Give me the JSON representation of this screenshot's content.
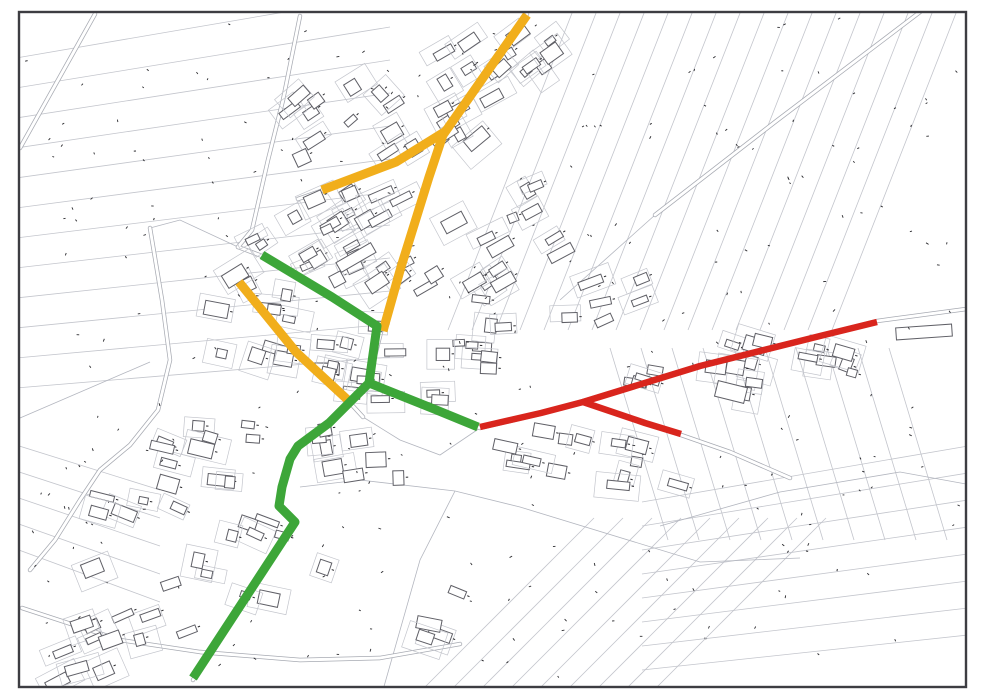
{
  "page": {
    "background": "#ffffff"
  },
  "map": {
    "type": "cadastral-plan-with-route-overlays",
    "frame": {
      "x": 19,
      "y": 12,
      "width": 947,
      "height": 675,
      "stroke": "#3d3d42",
      "stroke_width": 2.4
    },
    "palette": {
      "parcel_line": "#c3c5cc",
      "boundary_line": "#b3b6bf",
      "building_outline": "#5f5f66",
      "building_fill": "#ffffff",
      "road_casing": "#a7aab2",
      "road_fill": "#ffffff",
      "label_speck": "#2a2a2e",
      "route_yellow": "#F1AE1B",
      "route_green": "#3DA639",
      "route_red": "#D9251D"
    },
    "routes": [
      {
        "name": "route-yellow-main-north",
        "color_key": "route_yellow",
        "width": 9,
        "points": [
          [
            527,
            15
          ],
          [
            443,
            135
          ],
          [
            429,
            177
          ],
          [
            401,
            267
          ],
          [
            383,
            331
          ]
        ]
      },
      {
        "name": "route-yellow-branch-west",
        "color_key": "route_yellow",
        "width": 9,
        "points": [
          [
            446,
            131
          ],
          [
            396,
            162
          ],
          [
            322,
            190
          ]
        ]
      },
      {
        "name": "route-yellow-secondary-sw",
        "color_key": "route_yellow",
        "width": 9,
        "points": [
          [
            239,
            282
          ],
          [
            296,
            352
          ],
          [
            350,
            402
          ]
        ]
      },
      {
        "name": "route-green-northeast-diagonal",
        "color_key": "route_green",
        "width": 9,
        "points": [
          [
            262,
            255
          ],
          [
            332,
            297
          ],
          [
            377,
            326
          ],
          [
            369,
            383
          ]
        ]
      },
      {
        "name": "route-green-east-connector",
        "color_key": "route_green",
        "width": 9,
        "points": [
          [
            369,
            383
          ],
          [
            404,
            397
          ],
          [
            434,
            409
          ],
          [
            478,
            427
          ]
        ]
      },
      {
        "name": "route-green-south-main",
        "color_key": "route_green",
        "width": 9,
        "points": [
          [
            369,
            383
          ],
          [
            349,
            403
          ],
          [
            329,
            423
          ],
          [
            298,
            446
          ],
          [
            290,
            459
          ],
          [
            282,
            487
          ],
          [
            279,
            506
          ],
          [
            295,
            522
          ],
          [
            193,
            678
          ]
        ]
      },
      {
        "name": "route-red-east-main",
        "color_key": "route_red",
        "width": 6.5,
        "points": [
          [
            480,
            427
          ],
          [
            541,
            413
          ],
          [
            583,
            402
          ],
          [
            700,
            366
          ],
          [
            820,
            336
          ],
          [
            877,
            322
          ]
        ]
      },
      {
        "name": "route-red-south-branch",
        "color_key": "route_red",
        "width": 6.5,
        "points": [
          [
            583,
            402
          ],
          [
            645,
            423
          ],
          [
            681,
            434
          ]
        ]
      }
    ],
    "roads": [
      {
        "name": "road-main-north",
        "points": [
          [
            527,
            14
          ],
          [
            443,
            135
          ],
          [
            428,
            178
          ],
          [
            400,
            268
          ],
          [
            381,
            332
          ],
          [
            368,
            384
          ]
        ]
      },
      {
        "name": "road-southwest-main",
        "points": [
          [
            368,
            384
          ],
          [
            348,
            404
          ],
          [
            328,
            424
          ],
          [
            297,
            447
          ],
          [
            289,
            460
          ],
          [
            281,
            487
          ],
          [
            278,
            506
          ],
          [
            294,
            522
          ],
          [
            193,
            680
          ]
        ]
      },
      {
        "name": "road-branch-west",
        "points": [
          [
            450,
            128
          ],
          [
            393,
            164
          ],
          [
            318,
            192
          ],
          [
            298,
            199
          ]
        ]
      },
      {
        "name": "road-green-diagonal",
        "points": [
          [
            238,
            247
          ],
          [
            262,
            256
          ],
          [
            330,
            296
          ],
          [
            378,
            326
          ]
        ]
      },
      {
        "name": "road-yellow-secondary",
        "points": [
          [
            236,
            279
          ],
          [
            295,
            351
          ],
          [
            352,
            405
          ],
          [
            363,
            417
          ]
        ]
      },
      {
        "name": "road-east-main",
        "points": [
          [
            368,
            384
          ],
          [
            432,
            410
          ],
          [
            480,
            428
          ],
          [
            540,
            414
          ],
          [
            583,
            401
          ],
          [
            700,
            366
          ],
          [
            877,
            321
          ],
          [
            966,
            309
          ]
        ]
      },
      {
        "name": "road-east-branch",
        "points": [
          [
            583,
            401
          ],
          [
            648,
            424
          ],
          [
            684,
            436
          ],
          [
            730,
            452
          ],
          [
            790,
            478
          ]
        ]
      },
      {
        "name": "road-west-ring",
        "points": [
          [
            150,
            228
          ],
          [
            162,
            300
          ],
          [
            170,
            360
          ],
          [
            158,
            410
          ],
          [
            130,
            445
          ],
          [
            100,
            470
          ],
          [
            80,
            500
          ],
          [
            55,
            540
          ],
          [
            30,
            570
          ]
        ]
      },
      {
        "name": "road-south-lower",
        "points": [
          [
            22,
            608
          ],
          [
            120,
            640
          ],
          [
            200,
            652
          ],
          [
            300,
            660
          ],
          [
            380,
            658
          ],
          [
            460,
            644
          ]
        ]
      },
      {
        "name": "road-northwest-diag",
        "points": [
          [
            20,
            148
          ],
          [
            95,
            14
          ]
        ]
      },
      {
        "name": "road-north-entrance",
        "points": [
          [
            300,
            16
          ],
          [
            283,
            100
          ],
          [
            268,
            160
          ],
          [
            252,
            230
          ],
          [
            238,
            247
          ]
        ]
      },
      {
        "name": "road-northeast-diag",
        "points": [
          [
            655,
            215
          ],
          [
            775,
            122
          ],
          [
            920,
            12
          ]
        ]
      }
    ],
    "boundaries": [
      {
        "points": [
          [
            560,
            300
          ],
          [
            655,
            215
          ]
        ]
      },
      {
        "points": [
          [
            300,
            487
          ],
          [
            360,
            480
          ],
          [
            455,
            491
          ],
          [
            520,
            507
          ],
          [
            700,
            562
          ],
          [
            800,
            558
          ]
        ]
      },
      {
        "points": [
          [
            455,
            491
          ],
          [
            420,
            560
          ],
          [
            383,
            690
          ]
        ]
      },
      {
        "points": [
          [
            660,
            526
          ],
          [
            780,
            492
          ],
          [
            900,
            472
          ],
          [
            966,
            484
          ]
        ]
      },
      {
        "points": [
          [
            20,
            418
          ],
          [
            150,
            362
          ]
        ]
      },
      {
        "points": [
          [
            238,
            247
          ],
          [
            180,
            220
          ],
          [
            150,
            228
          ]
        ]
      },
      {
        "points": [
          [
            363,
            417
          ],
          [
            400,
            440
          ],
          [
            440,
            455
          ],
          [
            480,
            428
          ]
        ]
      }
    ],
    "fields": [
      {
        "name": "field-strips-northwest",
        "count": 12,
        "x1": 16,
        "y1": 58,
        "x2": 390,
        "y2": -6,
        "sx1": 0,
        "sy1": 30,
        "sx2": 0,
        "sy2": 33
      },
      {
        "name": "field-strips-northeast",
        "count": 17,
        "x1": 574,
        "y1": 8,
        "x2": 448,
        "y2": 330,
        "sx1": 24,
        "sy1": 0,
        "sx2": 24,
        "sy2": 0
      },
      {
        "name": "field-strips-southeast",
        "count": 10,
        "x1": 610,
        "y1": 348,
        "x2": 668,
        "y2": 540,
        "sx1": 31,
        "sy1": 0,
        "sx2": 31,
        "sy2": 0
      },
      {
        "name": "field-strips-bottomright",
        "count": 8,
        "x1": 642,
        "y1": 502,
        "x2": 968,
        "y2": 446,
        "sx1": 0,
        "sy1": 24,
        "sx2": 0,
        "sy2": 27
      },
      {
        "name": "field-strips-bottomcenter",
        "count": 9,
        "x1": 420,
        "y1": 692,
        "x2": 594,
        "y2": 518,
        "sx1": 29,
        "sy1": 0,
        "sx2": 29,
        "sy2": 0
      },
      {
        "name": "field-strips-westlower",
        "count": 5,
        "x1": 16,
        "y1": 445,
        "x2": 160,
        "y2": 490,
        "sx1": 0,
        "sy1": 26,
        "sx2": 0,
        "sy2": 28
      }
    ],
    "building_clusters": [
      {
        "name": "c-north-village",
        "cx": 500,
        "cy": 70,
        "count": 14,
        "angle": -35,
        "sx": 60,
        "sy": 38
      },
      {
        "name": "c-north-village-2",
        "cx": 430,
        "cy": 120,
        "count": 10,
        "angle": -35,
        "sx": 50,
        "sy": 30
      },
      {
        "name": "c-upper-mid",
        "cx": 360,
        "cy": 185,
        "count": 14,
        "angle": -30,
        "sx": 70,
        "sy": 45
      },
      {
        "name": "c-mid-west",
        "cx": 295,
        "cy": 250,
        "count": 12,
        "angle": -28,
        "sx": 60,
        "sy": 38
      },
      {
        "name": "c-mid-central",
        "cx": 435,
        "cy": 245,
        "count": 12,
        "angle": -30,
        "sx": 70,
        "sy": 50
      },
      {
        "name": "c-east-upper",
        "cx": 525,
        "cy": 215,
        "count": 7,
        "angle": -28,
        "sx": 45,
        "sy": 40
      },
      {
        "name": "c-west-band",
        "cx": 250,
        "cy": 330,
        "count": 10,
        "angle": 12,
        "sx": 55,
        "sy": 40
      },
      {
        "name": "c-central-band",
        "cx": 330,
        "cy": 370,
        "count": 10,
        "angle": 8,
        "sx": 55,
        "sy": 35
      },
      {
        "name": "c-central-east",
        "cx": 430,
        "cy": 360,
        "count": 9,
        "angle": 4,
        "sx": 60,
        "sy": 40
      },
      {
        "name": "c-scatter-east",
        "cx": 525,
        "cy": 330,
        "count": 7,
        "angle": 0,
        "sx": 55,
        "sy": 45
      },
      {
        "name": "c-far-east-upper",
        "cx": 618,
        "cy": 298,
        "count": 5,
        "angle": -18,
        "sx": 45,
        "sy": 30
      },
      {
        "name": "c-redroad-north",
        "cx": 700,
        "cy": 362,
        "count": 9,
        "angle": 14,
        "sx": 65,
        "sy": 26
      },
      {
        "name": "c-redroad-east",
        "cx": 800,
        "cy": 368,
        "count": 9,
        "angle": 14,
        "sx": 70,
        "sy": 30
      },
      {
        "name": "c-redroad-south",
        "cx": 560,
        "cy": 442,
        "count": 8,
        "angle": 10,
        "sx": 60,
        "sy": 30
      },
      {
        "name": "c-redbranch",
        "cx": 645,
        "cy": 462,
        "count": 6,
        "angle": 12,
        "sx": 45,
        "sy": 25
      },
      {
        "name": "c-south-central",
        "cx": 360,
        "cy": 452,
        "count": 8,
        "angle": -8,
        "sx": 55,
        "sy": 35
      },
      {
        "name": "c-southwest-inner",
        "cx": 205,
        "cy": 450,
        "count": 8,
        "angle": 10,
        "sx": 50,
        "sy": 35
      },
      {
        "name": "c-west-lower",
        "cx": 140,
        "cy": 482,
        "count": 8,
        "angle": 18,
        "sx": 45,
        "sy": 40
      },
      {
        "name": "c-south-village",
        "cx": 262,
        "cy": 562,
        "count": 10,
        "angle": 18,
        "sx": 70,
        "sy": 45
      },
      {
        "name": "c-south-scatter",
        "cx": 420,
        "cy": 618,
        "count": 4,
        "angle": 18,
        "sx": 40,
        "sy": 30
      },
      {
        "name": "c-bottomleft",
        "cx": 135,
        "cy": 600,
        "count": 8,
        "angle": -22,
        "sx": 55,
        "sy": 40
      },
      {
        "name": "c-bottomleft-2",
        "cx": 95,
        "cy": 660,
        "count": 6,
        "angle": -22,
        "sx": 45,
        "sy": 25
      },
      {
        "name": "c-nw-edge",
        "cx": 318,
        "cy": 118,
        "count": 6,
        "angle": -35,
        "sx": 45,
        "sy": 35
      }
    ],
    "long_buildings": [
      {
        "x": 896,
        "y": 326,
        "w": 56,
        "h": 12,
        "angle": -4
      },
      {
        "x": 548,
        "y": 248,
        "w": 26,
        "h": 10,
        "angle": -28
      },
      {
        "x": 336,
        "y": 252,
        "w": 40,
        "h": 11,
        "angle": -30
      },
      {
        "x": 716,
        "y": 384,
        "w": 30,
        "h": 16,
        "angle": 14
      }
    ],
    "speck_seed": 42,
    "speck_count": 240
  }
}
